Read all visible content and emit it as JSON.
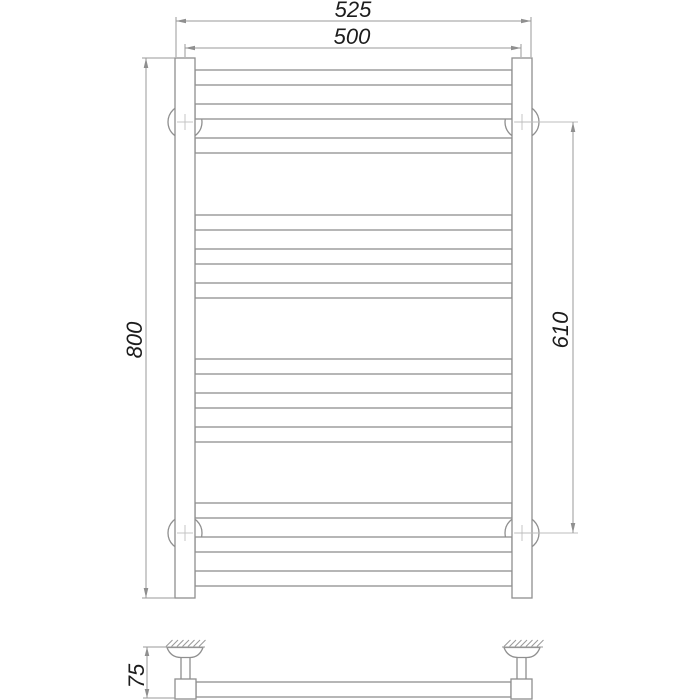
{
  "dimensions": {
    "overall_width": "525",
    "mounting_width": "500",
    "overall_height": "800",
    "bracket_distance": "610",
    "wall_distance": "75"
  }
}
